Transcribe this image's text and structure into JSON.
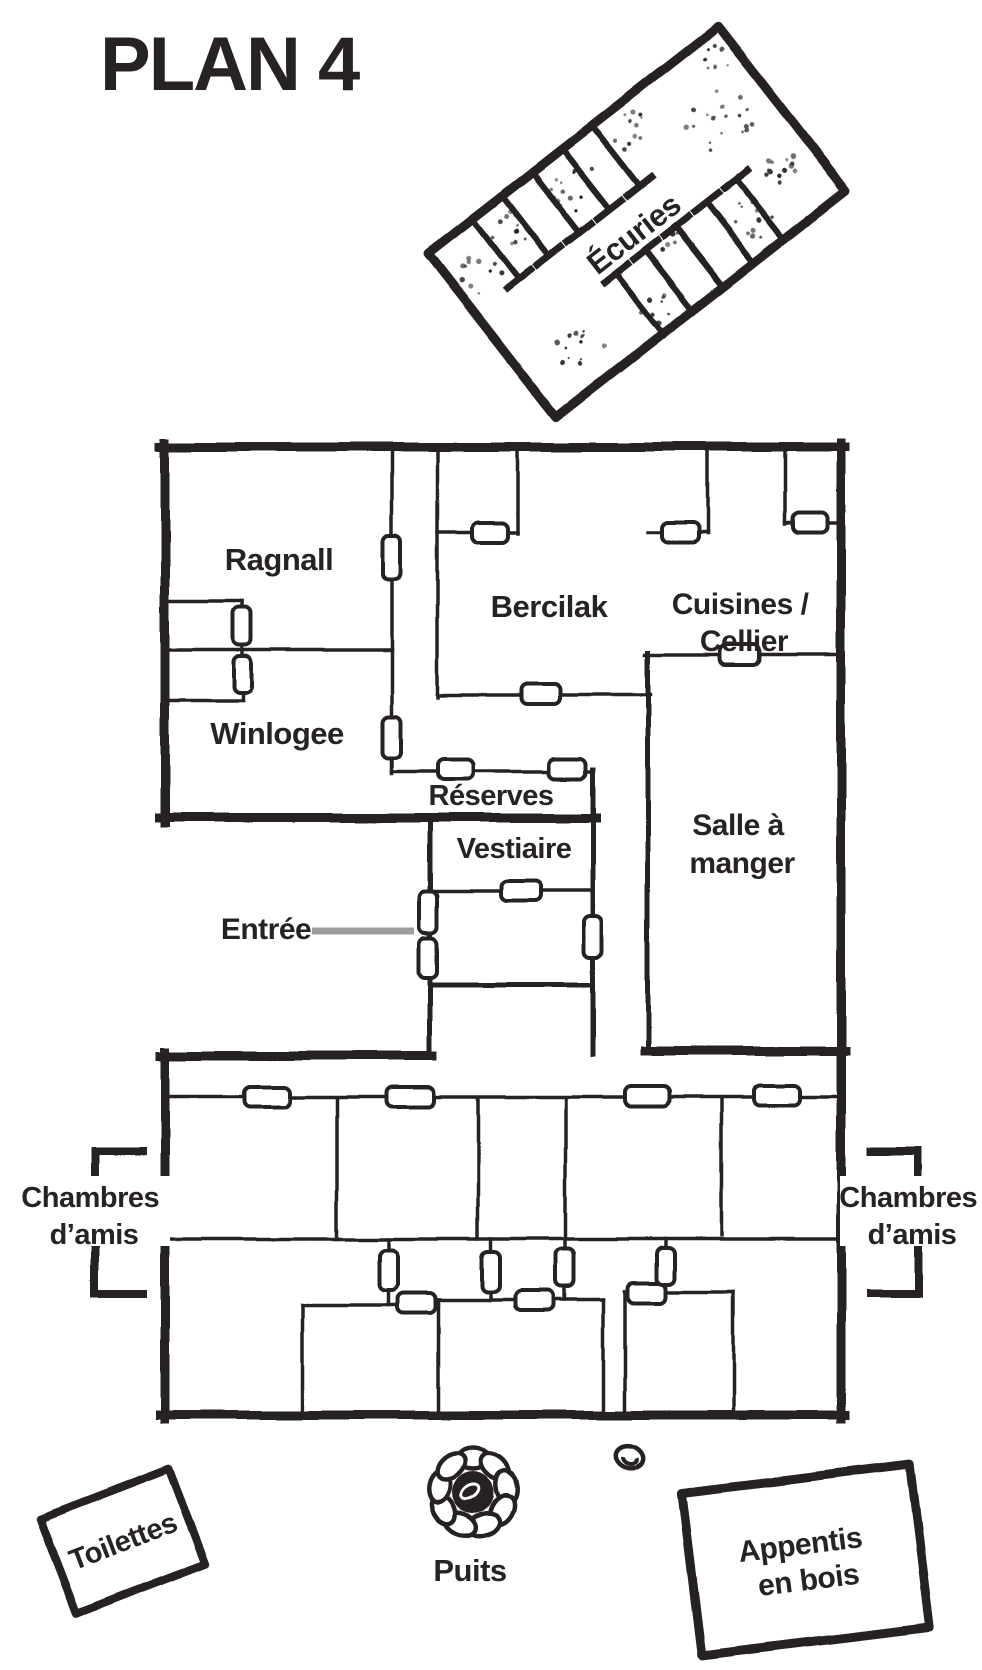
{
  "page": {
    "title": "PLAN 4",
    "paper_color": "#ffffff",
    "ink_color": "#272324",
    "pointer_gray": "#9e9e9e"
  },
  "rooms": {
    "ecuries": "Écuries",
    "ragnall": "Ragnall",
    "bercilak": "Bercilak",
    "cuisines": {
      "line1": "Cuisines /",
      "line2": "Cellier"
    },
    "winlogee": "Winlogee",
    "reserves": "Réserves",
    "vestiaire": "Vestiaire",
    "entree": "Entrée",
    "salle": {
      "line1": "Salle à",
      "line2": "manger"
    },
    "chambres_left": {
      "line1": "Chambres",
      "line2": "d’amis"
    },
    "chambres_right": {
      "line1": "Chambres",
      "line2": "d’amis"
    },
    "toilettes": "Toilettes",
    "puits": "Puits",
    "appentis": {
      "line1": "Appentis",
      "line2": "en bois"
    }
  }
}
